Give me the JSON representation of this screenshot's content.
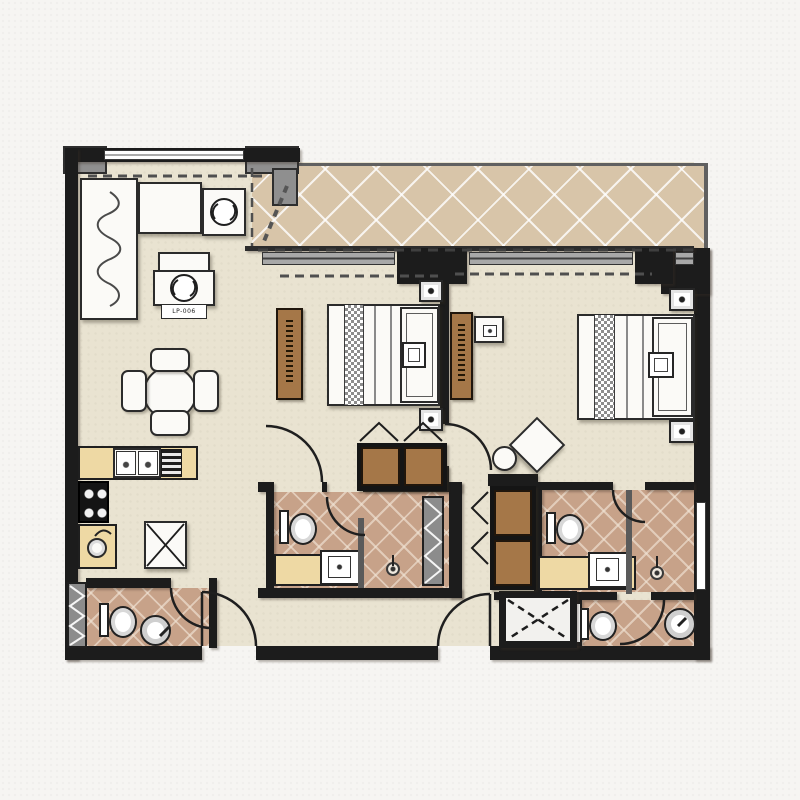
{
  "document": {
    "type": "apartment-floor-plan",
    "style": "rendered-2bed-2bath-interior-plan",
    "label_unit": "LP-006"
  },
  "palette": {
    "paper": "#f6f5f2",
    "floor_cream": "#e9e3d1",
    "balcony_tile": "#d8c5a9",
    "bath_tile": "#c7a289",
    "wall_dark": "#1c1c1c",
    "wood_brown": "#a57748",
    "counter_yellow": "#eed9a4",
    "furniture_white": "#fbfaf7",
    "frame_gray": "#8f8f8f"
  },
  "rooms": [
    {
      "id": "living-dining",
      "fixtures": [
        "l-shaped-sofa",
        "armchair-side-table",
        "coffee-table-lp-006",
        "round-dining-table-4-chairs",
        "top-window"
      ]
    },
    {
      "id": "balcony",
      "fixtures": [
        "diamond-tile-floor",
        "sliding-window-wall",
        "drapery-symbol"
      ]
    },
    {
      "id": "bedroom-1",
      "fixtures": [
        "double-bed",
        "runner",
        "headboard",
        "nightstand-x2",
        "dresser",
        "sliding-wardrobe",
        "bulkhead-dashed-line"
      ]
    },
    {
      "id": "bedroom-2",
      "fixtures": [
        "double-bed",
        "runner",
        "headboard",
        "nightstand-x2",
        "dresser",
        "tv-box",
        "desk-chair",
        "stool",
        "wardrobe"
      ]
    },
    {
      "id": "kitchen",
      "fixtures": [
        "double-sink",
        "dish-drainer",
        "4-burner-stove",
        "bar-sink",
        "washer-x-box"
      ]
    },
    {
      "id": "bathroom-1",
      "fixtures": [
        "toilet",
        "vanity-sink",
        "shower-drain",
        "service-shaft"
      ]
    },
    {
      "id": "master-bathroom",
      "fixtures": [
        "toilet",
        "vanity-sink",
        "shower-drain",
        "side-window"
      ]
    },
    {
      "id": "guest-bathroom",
      "fixtures": [
        "toilet",
        "pedestal-basin"
      ]
    },
    {
      "id": "powder-room",
      "fixtures": [
        "toilet",
        "round-basin",
        "vent-shaft"
      ]
    },
    {
      "id": "entry",
      "fixtures": [
        "entrance-door",
        "lobby-door",
        "duct-shaft-x"
      ]
    }
  ]
}
